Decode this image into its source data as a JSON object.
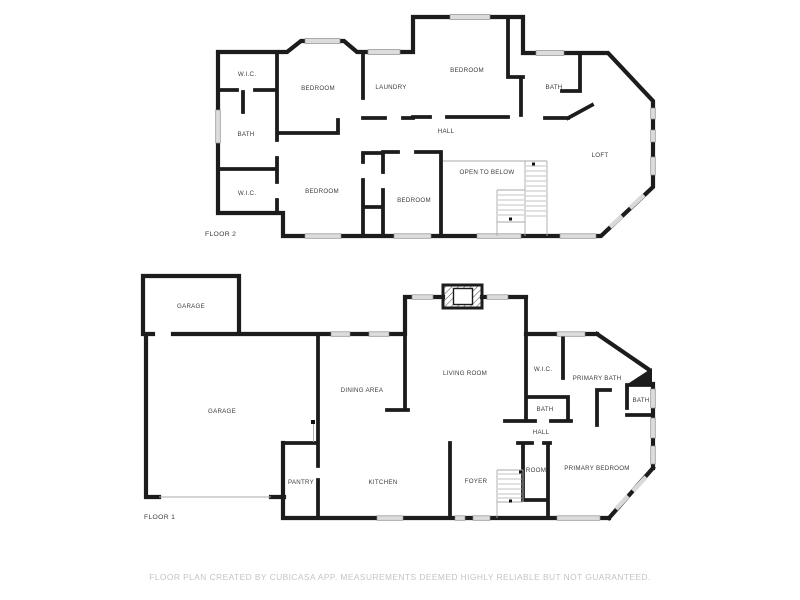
{
  "footer": {
    "disclaimer": "FLOOR PLAN CREATED BY CUBICASA APP. MEASUREMENTS DEEMED HIGHLY RELIABLE BUT NOT GUARANTEED."
  },
  "floor2": {
    "name": "FLOOR 2",
    "rooms": {
      "wic_upper": {
        "label": "W.I.C."
      },
      "bedroom_nw": {
        "label": "BEDROOM"
      },
      "laundry": {
        "label": "LAUNDRY"
      },
      "bedroom_n": {
        "label": "BEDROOM"
      },
      "bath_e": {
        "label": "BATH"
      },
      "hall": {
        "label": "HALL"
      },
      "bath_w": {
        "label": "BATH"
      },
      "wic_lower": {
        "label": "W.I.C."
      },
      "bedroom_sw": {
        "label": "BEDROOM"
      },
      "bedroom_s": {
        "label": "BEDROOM"
      },
      "open_to_below": {
        "label": "OPEN TO BELOW"
      },
      "loft": {
        "label": "LOFT"
      }
    }
  },
  "floor1": {
    "name": "FLOOR 1",
    "rooms": {
      "garage_upper": {
        "label": "GARAGE"
      },
      "garage_main": {
        "label": "GARAGE"
      },
      "dining_area": {
        "label": "DINING AREA"
      },
      "living_room": {
        "label": "LIVING ROOM"
      },
      "wic": {
        "label": "W.I.C."
      },
      "primary_bath": {
        "label": "PRIMARY BATH"
      },
      "bath_corner": {
        "label": "BATH"
      },
      "bath_hall": {
        "label": "BATH"
      },
      "hall": {
        "label": "HALL"
      },
      "pantry": {
        "label": "PANTRY"
      },
      "kitchen": {
        "label": "KITCHEN"
      },
      "foyer": {
        "label": "FOYER"
      },
      "room": {
        "label": "ROOM"
      },
      "primary_bedroom": {
        "label": "PRIMARY BEDROOM"
      }
    }
  },
  "colors": {
    "wall": "#1c1c1c",
    "window_fill": "#dcdcdc",
    "stair_line": "#b0b0b0",
    "room_text": "#3d3d3d",
    "footer_text": "#c4c4c4",
    "background": "#ffffff"
  }
}
